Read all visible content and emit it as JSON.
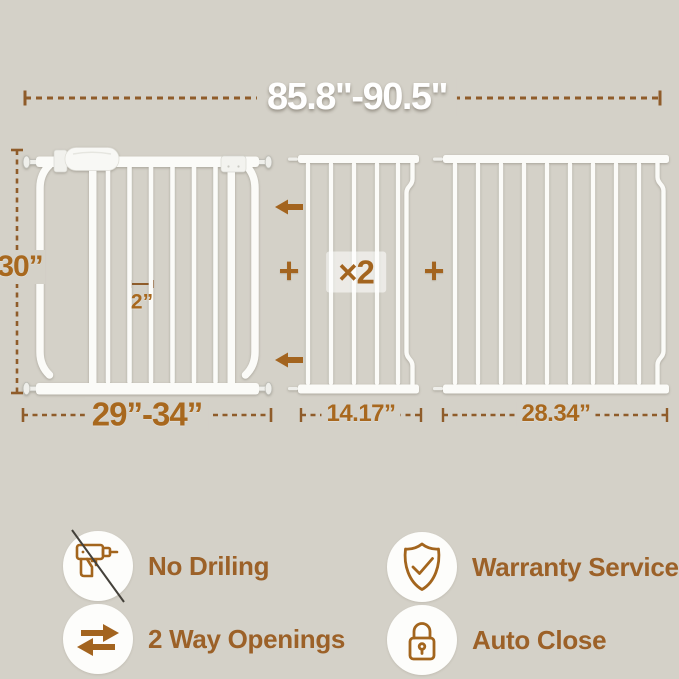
{
  "page": {
    "background_color": "#d4d1c8",
    "accent_brown": "#a3641f",
    "dimension_text_color": "#a8681e",
    "dash_line_color": "#8f5c2a",
    "gate_color": "#fbfbf8"
  },
  "top_dimension": {
    "width_range_label": "85.8\"-90.5\""
  },
  "gate": {
    "height_label": "30”",
    "bar_gap_label": "2”",
    "width_range_label": "29”-34”"
  },
  "extension_panels": {
    "multiplier_badge": "×2",
    "plus_sign_left": "+",
    "plus_sign_right": "+",
    "small_panel_width_label": "14.17”",
    "large_panel_width_label": "28.34”"
  },
  "features": [
    {
      "icon": "no-drill-icon",
      "label": "No Driling"
    },
    {
      "icon": "two-way-arrows-icon",
      "label": "2 Way Openings"
    },
    {
      "icon": "shield-check-icon",
      "label": "Warranty Service"
    },
    {
      "icon": "lock-icon",
      "label": "Auto Close"
    }
  ]
}
